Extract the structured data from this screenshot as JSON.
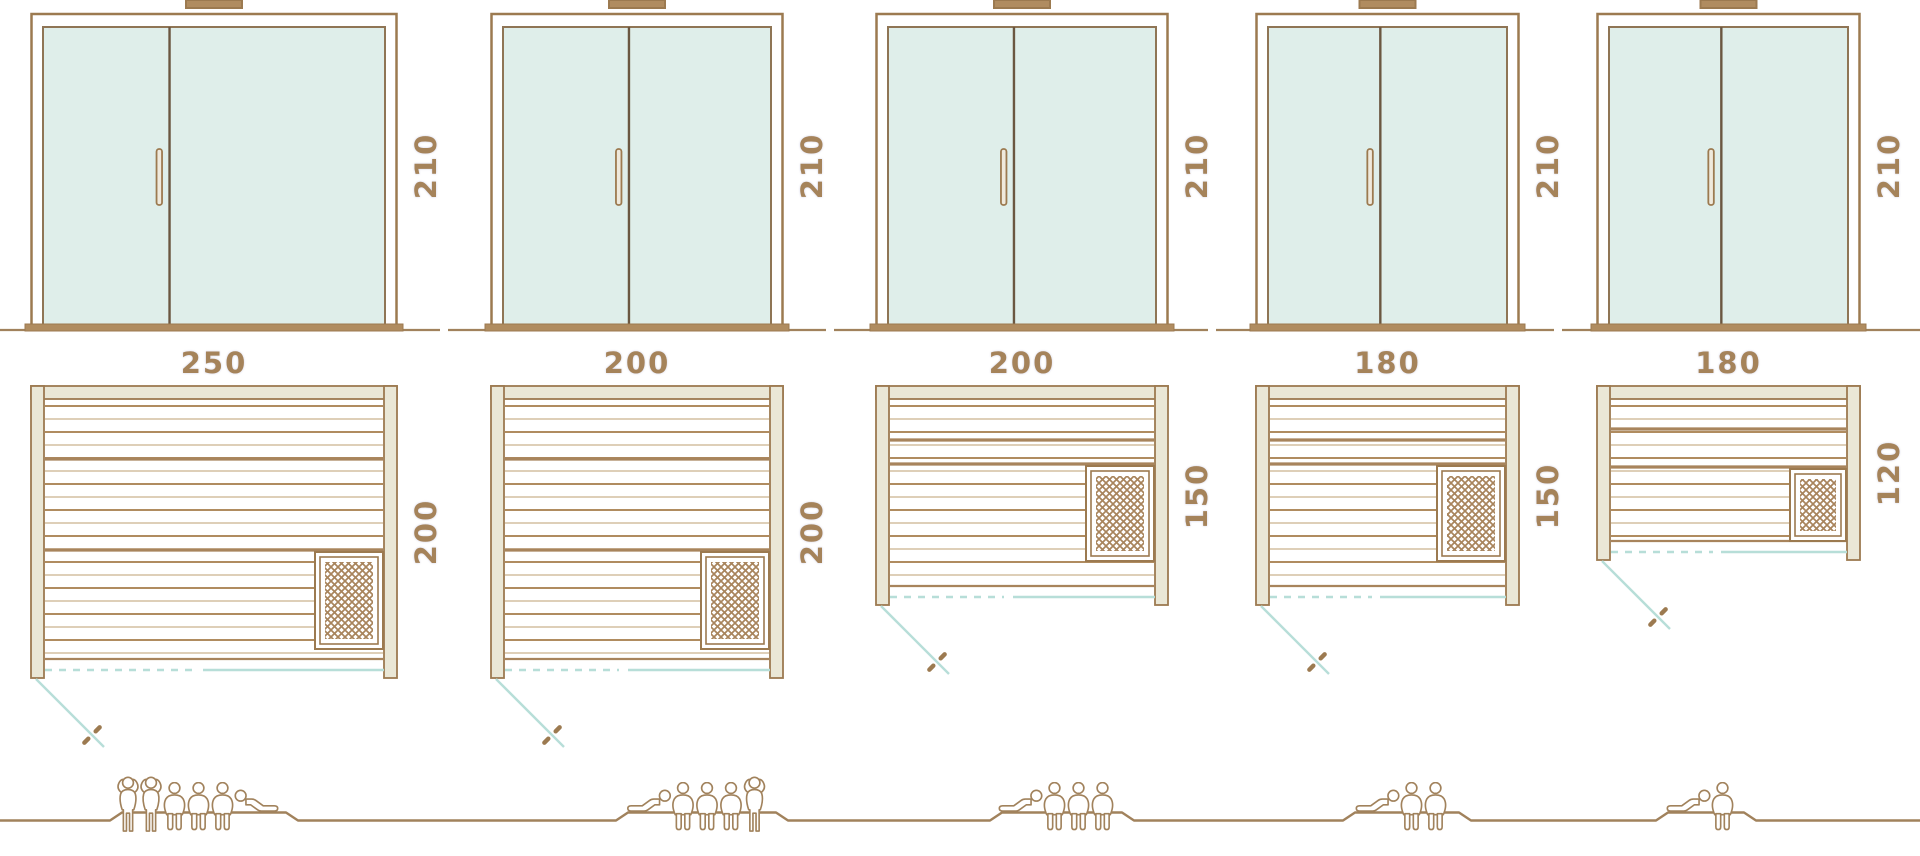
{
  "diagram_title": "sauna-size-comparison",
  "colors": {
    "outline": "#9c7a50",
    "wood_dark": "#a8845c",
    "wood_light": "#d4bfa0",
    "wall_fill": "#eae7d6",
    "glass_fill": "#dfeeea",
    "glass_stroke": "#8f7555",
    "divider": "#6b5741",
    "label_text": "#a5835a",
    "door_swing": "#b7ded8",
    "ground": "#a1825c"
  },
  "models": [
    {
      "id": "sauna-250x200",
      "door": {
        "height_label": "210",
        "height_cm": 210
      },
      "plan": {
        "width_label": "250",
        "width_cm": 250,
        "depth_label": "200",
        "depth_cm": 200,
        "heater_position": "bottom-right"
      },
      "capacity": {
        "count": 6,
        "figures": [
          "standing",
          "standing",
          "sitting",
          "sitting",
          "sitting",
          "lying-mirrored"
        ]
      }
    },
    {
      "id": "sauna-200x200",
      "door": {
        "height_label": "210",
        "height_cm": 210
      },
      "plan": {
        "width_label": "200",
        "width_cm": 200,
        "depth_label": "200",
        "depth_cm": 200,
        "heater_position": "bottom-right"
      },
      "capacity": {
        "count": 5,
        "figures": [
          "lying",
          "sitting",
          "sitting",
          "sitting",
          "standing"
        ]
      }
    },
    {
      "id": "sauna-200x150",
      "door": {
        "height_label": "210",
        "height_cm": 210
      },
      "plan": {
        "width_label": "200",
        "width_cm": 200,
        "depth_label": "150",
        "depth_cm": 150,
        "heater_position": "middle-right"
      },
      "capacity": {
        "count": 4,
        "figures": [
          "lying",
          "sitting",
          "sitting",
          "sitting"
        ]
      }
    },
    {
      "id": "sauna-180x150",
      "door": {
        "height_label": "210",
        "height_cm": 210
      },
      "plan": {
        "width_label": "180",
        "width_cm": 180,
        "depth_label": "150",
        "depth_cm": 150,
        "heater_position": "middle-right"
      },
      "capacity": {
        "count": 3,
        "figures": [
          "lying",
          "sitting",
          "sitting"
        ]
      }
    },
    {
      "id": "sauna-180x120",
      "door": {
        "height_label": "210",
        "height_cm": 210
      },
      "plan": {
        "width_label": "180",
        "width_cm": 180,
        "depth_label": "120",
        "depth_cm": 120,
        "heater_position": "middle-right"
      },
      "capacity": {
        "count": 2,
        "figures": [
          "lying",
          "sitting"
        ]
      }
    }
  ]
}
